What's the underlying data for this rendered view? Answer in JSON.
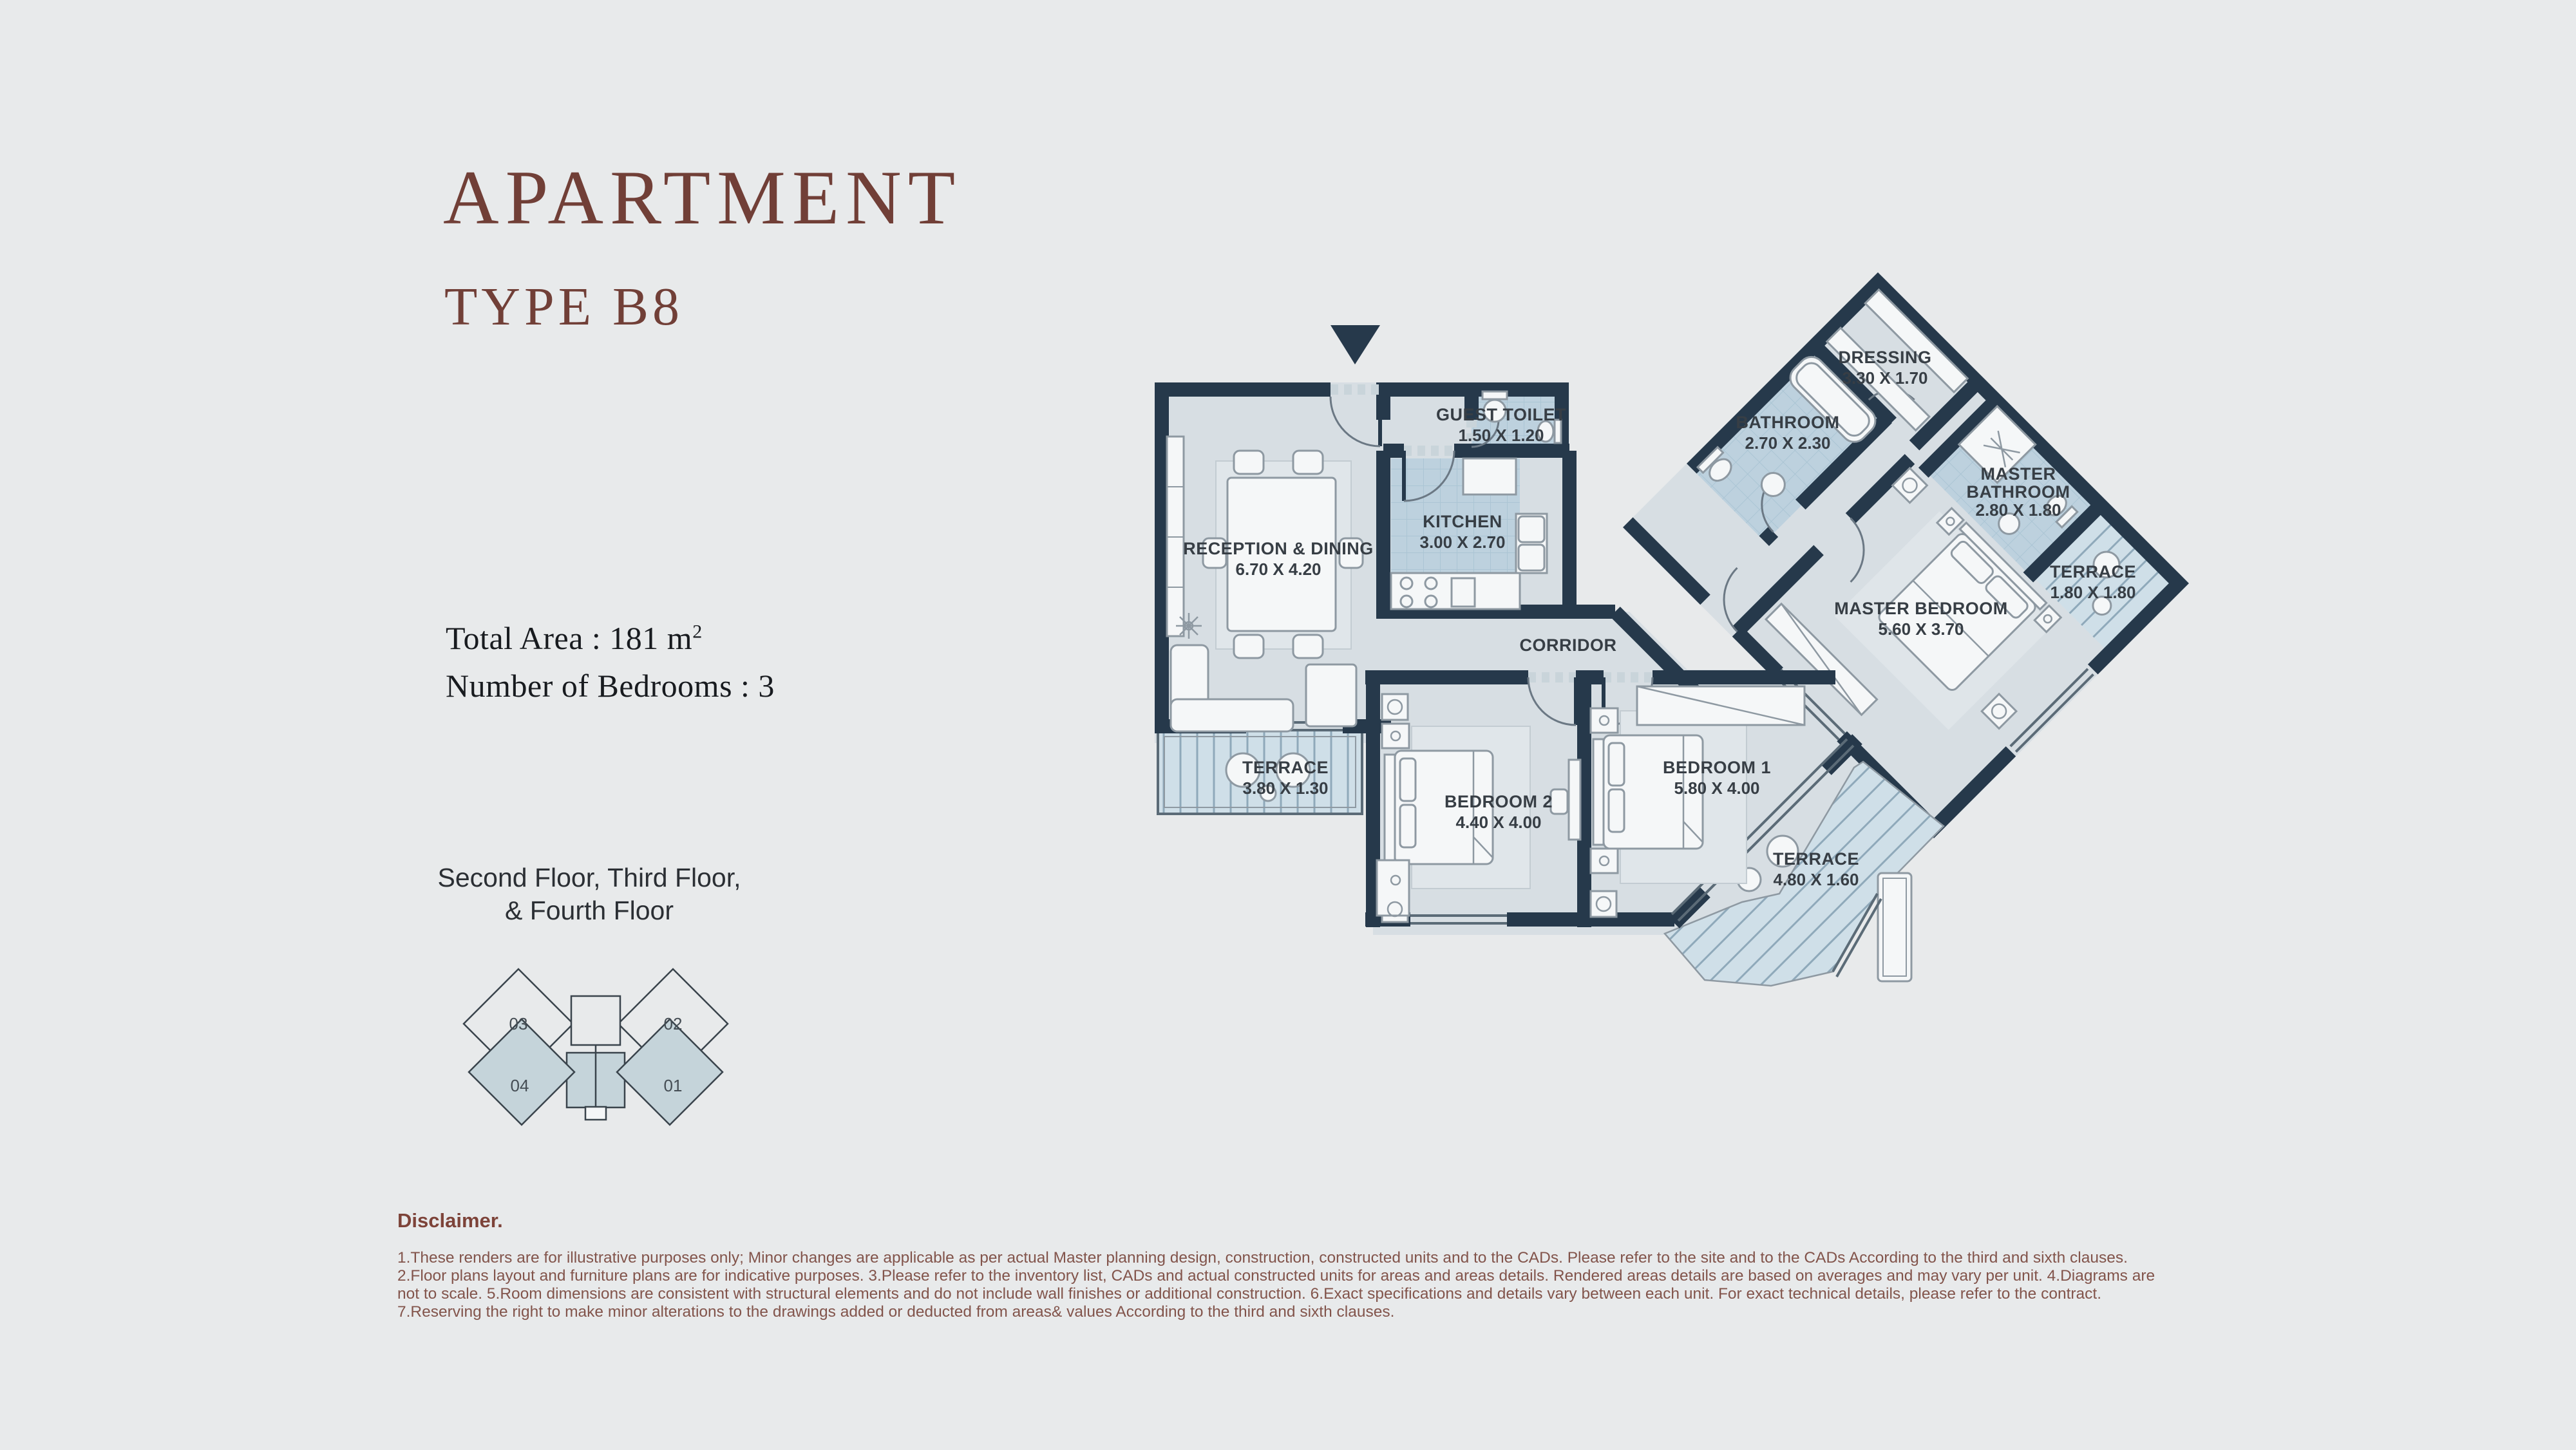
{
  "header": {
    "title": "APARTMENT",
    "subtitle": "TYPE B8"
  },
  "stats": {
    "total_area_label": "Total Area : 181 m",
    "total_area_sup": "2",
    "bedrooms": "Number of Bedrooms : 3"
  },
  "floors": {
    "line1": "Second Floor, Third Floor,",
    "line2": "& Fourth Floor"
  },
  "key_plan": {
    "units": [
      {
        "id": "03"
      },
      {
        "id": "02"
      },
      {
        "id": "04"
      },
      {
        "id": "01"
      }
    ]
  },
  "plan": {
    "rooms": [
      {
        "key": "reception",
        "name": "RECEPTION & DINING",
        "dims": "6.70 X 4.20"
      },
      {
        "key": "kitchen",
        "name": "KITCHEN",
        "dims": "3.00 X 2.70"
      },
      {
        "key": "guest-toilet",
        "name": "GUEST TOILET",
        "dims": "1.50 X 1.20"
      },
      {
        "key": "corridor",
        "name": "CORRIDOR",
        "dims": ""
      },
      {
        "key": "terrace-reception",
        "name": "TERRACE",
        "dims": "3.80 X 1.30"
      },
      {
        "key": "bedroom-2",
        "name": "BEDROOM 2",
        "dims": "4.40 X 4.00"
      },
      {
        "key": "bedroom-1",
        "name": "BEDROOM 1",
        "dims": "5.80 X 4.00"
      },
      {
        "key": "terrace-bedroom",
        "name": "TERRACE",
        "dims": "4.80 X 1.60"
      },
      {
        "key": "dressing",
        "name": "DRESSING",
        "dims": "3.30 X 1.70"
      },
      {
        "key": "bathroom",
        "name": "BATHROOM",
        "dims": "2.70 X 2.30"
      },
      {
        "key": "master-bathroom",
        "name_line1": "MASTER",
        "name_line2": "BATHROOM",
        "dims": "2.80 X 1.80"
      },
      {
        "key": "terrace-master",
        "name": "TERRACE",
        "dims": "1.80 X 1.80"
      },
      {
        "key": "master-bedroom",
        "name": "MASTER BEDROOM",
        "dims": "5.60 X 3.70"
      }
    ]
  },
  "disclaimer": {
    "heading": "Disclaimer.",
    "lines": [
      "1.These renders are for illustrative purposes only; Minor changes are applicable as per actual Master planning design, construction, constructed units and to the CADs. Please refer to the site and to the CADs According to the third and sixth clauses.",
      "2.Floor plans layout and furniture plans are for indicative purposes. 3.Please refer to the inventory list, CADs and actual constructed units for areas and areas details. Rendered areas details are based on averages and may vary per unit. 4.Diagrams are",
      "not to scale. 5.Room dimensions are consistent with structural elements and do not include wall finishes or additional construction. 6.Exact specifications and details vary between each unit. For exact technical details, please refer to the contract.",
      "7.Reserving the right to make minor alterations to the drawings  added or deducted from areas& values According to the third and sixth clauses."
    ]
  },
  "colors": {
    "background": "#e8eaeb",
    "accent_maroon": "#713f37",
    "wall": "#26394b",
    "room_fill": "#d7dee3",
    "wet_tile": "#bdd1de",
    "terrace_fill": "#cfdfe8",
    "keyplan_highlight": "#c5d4da"
  }
}
